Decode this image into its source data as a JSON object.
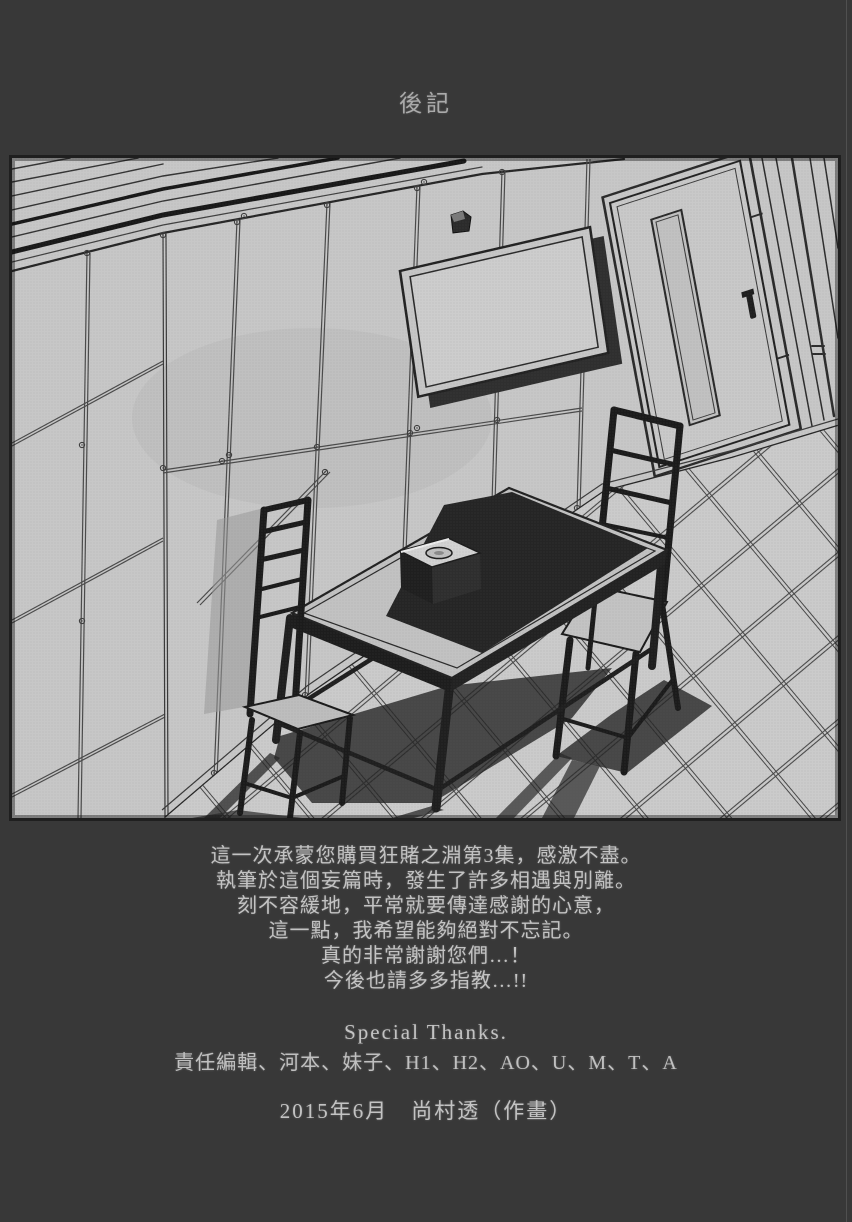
{
  "page": {
    "title": "後記",
    "afterword_lines": [
      "這一次承蒙您購買狂賭之淵第3集，感激不盡。",
      "執筆於這個妄篇時，發生了許多相遇與別離。",
      "刻不容緩地，平常就要傳達感謝的心意，",
      "這一點，我希望能夠絕對不忘記。",
      "真的非常謝謝您們…！",
      "今後也請多多指教…!!"
    ],
    "special_thanks_heading": "Special Thanks.",
    "special_thanks_names": "責任編輯、河本、妹子、H1、H2、AO、U、M、T、A",
    "date_credit": "2015年6月　尚村透（作畫）",
    "illustration_subject": "empty interrogation room with table, two chairs, wall monitor, security camera and metal-panel walls",
    "colors": {
      "background": "#383838",
      "text": "#c3c3c3",
      "illustration_paper": "#c7c7c7",
      "line_art": "#1e1e1e"
    }
  }
}
